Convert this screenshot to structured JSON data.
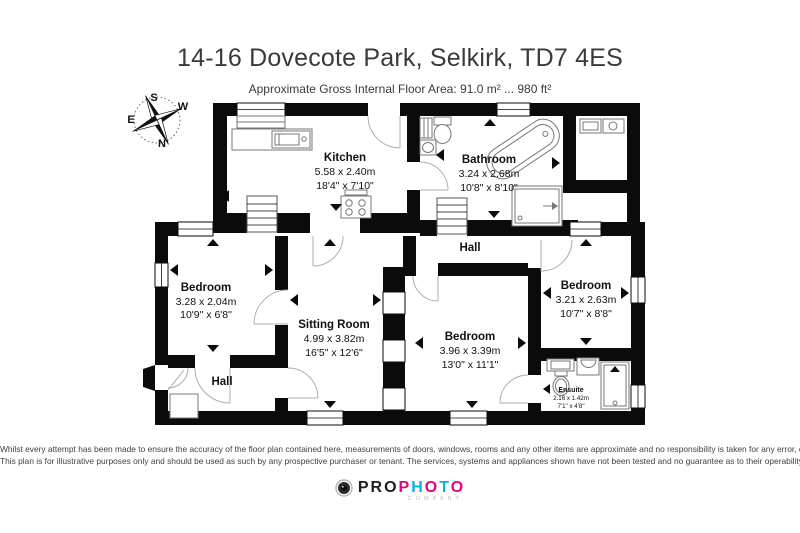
{
  "header": {
    "title": "14-16 Dovecote Park, Selkirk, TD7 4ES",
    "subtitle": "Approximate Gross Internal Floor Area: 91.0 m² ... 980 ft²"
  },
  "compass": {
    "north": "N",
    "south": "S",
    "east": "E",
    "west": "W"
  },
  "floorplan": {
    "rooms": {
      "kitchen": {
        "name": "Kitchen",
        "metric": "5.58 x 2.40m",
        "imperial": "18'4\" x 7'10\""
      },
      "bathroom": {
        "name": "Bathroom",
        "metric": "3.24 x 2.68m",
        "imperial": "10'8\" x 8'10\""
      },
      "bedroom_left": {
        "name": "Bedroom",
        "metric": "3.28 x 2.04m",
        "imperial": "10'9\" x 6'8\""
      },
      "sitting_room": {
        "name": "Sitting Room",
        "metric": "4.99 x 3.82m",
        "imperial": "16'5\" x 12'6\""
      },
      "bedroom_middle": {
        "name": "Bedroom",
        "metric": "3.96 x 3.39m",
        "imperial": "13'0\" x 11'1\""
      },
      "bedroom_right": {
        "name": "Bedroom",
        "metric": "3.21 x 2.63m",
        "imperial": "10'7\" x 8'8\""
      },
      "ensuite": {
        "name": "Ensuite",
        "metric": "2.16 x 1.42m",
        "imperial": "7'1\" x 4'8\""
      },
      "hall_top": {
        "name": "Hall"
      },
      "hall_bottom": {
        "name": "Hall"
      }
    }
  },
  "footer": {
    "disclaimer_line1": "Whilst every attempt has been made to ensure the accuracy of the floor plan contained here, measurements of doors, windows, rooms and any other items are approximate and no responsibility is taken for any error, omission or mis-statement.",
    "disclaimer_line2": "This plan is for illustrative purposes only and should be used as such by any prospective purchaser or tenant. The services, systems and appliances shown have not been tested and no guarantee as to their operability or efficiency can be given."
  },
  "logo": {
    "pro": "PRO",
    "photo_letters": [
      "P",
      "H",
      "O",
      "T",
      "O"
    ],
    "company": "COMPANY",
    "colors": {
      "magenta": "#e6007e",
      "cyan": "#00b4e5",
      "black": "#1d1d1b"
    }
  }
}
